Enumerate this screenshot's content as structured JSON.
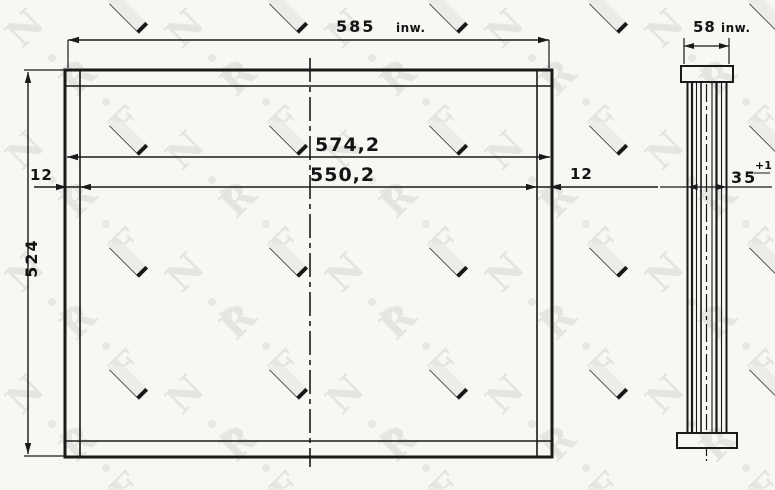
{
  "watermark": {
    "letters": [
      "N",
      "R",
      "F"
    ]
  },
  "front_view": {
    "dim_top_width": {
      "value": "585",
      "suffix": "inw."
    },
    "dim_outer_width": "574,2",
    "dim_core_width": "550,2",
    "dim_side_plate_left": "12",
    "dim_side_plate_right": "12",
    "dim_height": "524"
  },
  "side_view": {
    "dim_top_width": {
      "value": "58",
      "suffix": "inw."
    },
    "dim_thickness": {
      "value": "35",
      "tolerance": "+1"
    }
  },
  "colors": {
    "line_ink": "#1a1a1a",
    "paper": "#f7f7f4",
    "watermark_gray": "#e3e3de"
  }
}
